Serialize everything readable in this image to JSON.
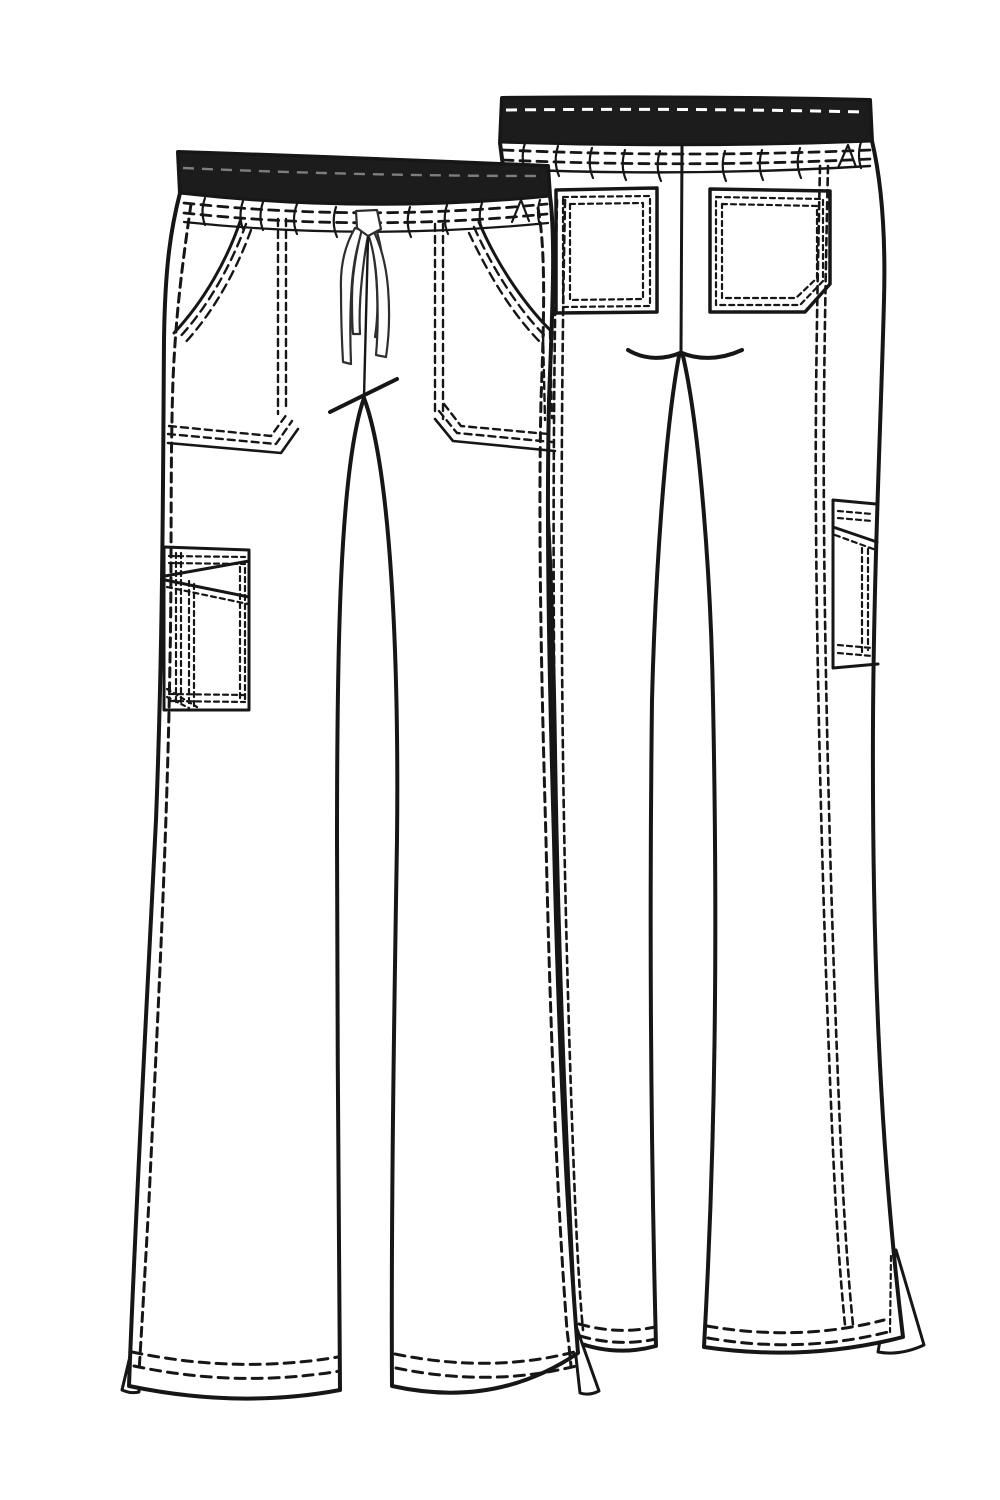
{
  "page": {
    "title": "Technical flat sketch of flare-leg drawstring scrub pants",
    "views": {
      "front": {
        "label": "front-view",
        "features": [
          "contrast-rib-waistband",
          "drawstring-tie",
          "slant-front-pockets",
          "left-leg-cargo-pocket",
          "topstitched-side-seams",
          "flare-hem-with-side-vents"
        ]
      },
      "back": {
        "label": "back-view",
        "features": [
          "contrast-rib-waistband",
          "two-back-patch-pockets",
          "angled-corner-right-pocket",
          "side-cargo-pocket",
          "center-back-seam",
          "flare-hem-with-side-vent"
        ]
      }
    }
  },
  "colors": {
    "paper": "#ffffff",
    "ink": "#161616",
    "band": "#1c1c1c",
    "draw": "#2e2e2e",
    "gray": "#7e7e7e"
  }
}
